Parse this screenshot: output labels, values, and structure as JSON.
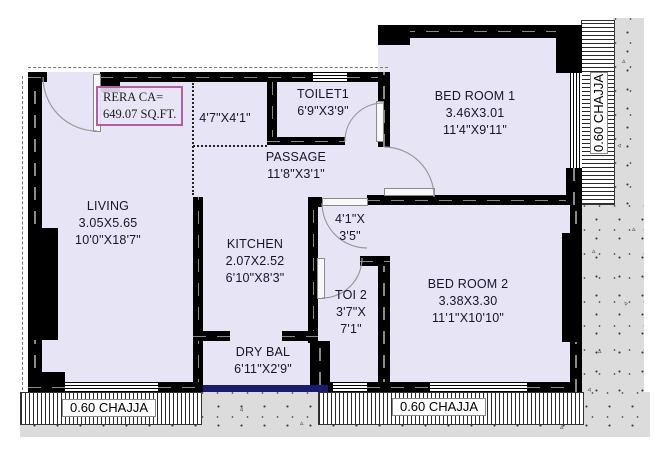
{
  "plan": {
    "rera": {
      "line1": "RERA CA=",
      "line2": "649.07 SQ.FT."
    },
    "chajja_label": "0.60 CHAJJA",
    "speck_glyph": "▵",
    "colors": {
      "floor": "#e7e4f6",
      "wall": "#000000",
      "rera_border": "#b05fa0",
      "balcony_edge": "#1b1b70",
      "ground_texture": "#dcdcdc"
    },
    "rooms": {
      "living": {
        "name": "LIVING",
        "dim_m": "3.05X5.65",
        "dim_ft": "10'0\"X18'7\""
      },
      "kitchen": {
        "name": "KITCHEN",
        "dim_m": "2.07X2.52",
        "dim_ft": "6'10\"X8'3\""
      },
      "toilet1": {
        "name": "TOILET1",
        "dim_ft": "6'9\"X3'9\""
      },
      "passage": {
        "name": "PASSAGE",
        "dim_ft": "11'8\"X3'1\""
      },
      "bedroom1": {
        "name": "BED ROOM 1",
        "dim_m": "3.46X3.01",
        "dim_ft": "11'4\"X9'11\""
      },
      "bedroom2": {
        "name": "BED ROOM 2",
        "dim_m": "3.38X3.30",
        "dim_ft": "11'1\"X10'10\""
      },
      "toi2": {
        "name": "TOI 2",
        "dim_ft_1": "3'7\"X",
        "dim_ft_2": "7'1\""
      },
      "drybal": {
        "name": "DRY BAL",
        "dim_ft": "6'11\"X2'9\""
      },
      "foyer": {
        "dim_ft": "4'7\"X4'1\""
      },
      "lobby": {
        "dim_ft_1": "4'1\"X",
        "dim_ft_2": "3'5\""
      }
    }
  }
}
